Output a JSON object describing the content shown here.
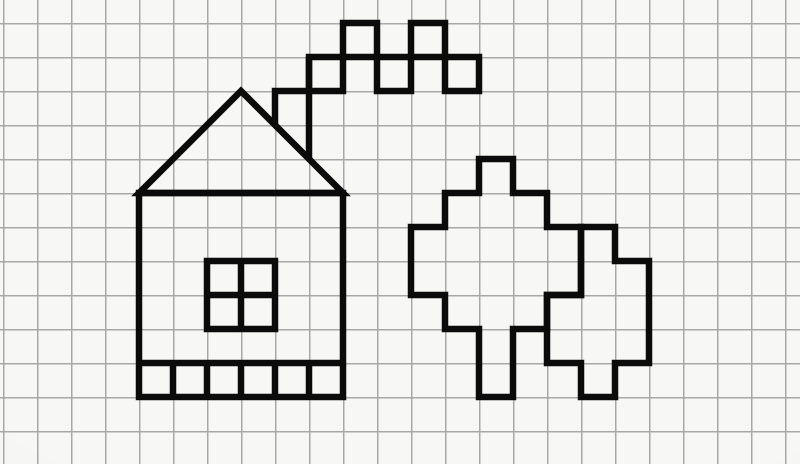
{
  "canvas": {
    "width": 800,
    "height": 464
  },
  "palette": {
    "ink": "#0b0b0b",
    "paper": "#f7f7f5",
    "grid_line": "#a8a8a8",
    "vignette": "rgba(95,95,90,0.13)"
  },
  "grid": {
    "cell": 34,
    "offset_x": 3,
    "offset_y": 23,
    "line_width": 1.3
  },
  "stroke_width": 6.5,
  "drawing": {
    "house": [
      {
        "name": "house-body",
        "type": "rect",
        "x": 139,
        "y": 193,
        "w": 204,
        "h": 204
      },
      {
        "name": "house-roof",
        "type": "polygon",
        "points": [
          [
            139,
            193
          ],
          [
            241,
            91
          ],
          [
            343,
            193
          ]
        ]
      },
      {
        "name": "window-frame",
        "type": "rect",
        "x": 207,
        "y": 261,
        "w": 68,
        "h": 68
      },
      {
        "name": "window-bar-vertical",
        "type": "line",
        "x1": 241,
        "y1": 261,
        "x2": 241,
        "y2": 329
      },
      {
        "name": "window-bar-horizontal",
        "type": "line",
        "x1": 207,
        "y1": 295,
        "x2": 275,
        "y2": 295
      },
      {
        "name": "foundation-top-line",
        "type": "line",
        "x1": 139,
        "y1": 363,
        "x2": 343,
        "y2": 363
      },
      {
        "name": "foundation-divider-1",
        "type": "line",
        "x1": 173,
        "y1": 363,
        "x2": 173,
        "y2": 397
      },
      {
        "name": "foundation-divider-2",
        "type": "line",
        "x1": 207,
        "y1": 363,
        "x2": 207,
        "y2": 397
      },
      {
        "name": "foundation-divider-3",
        "type": "line",
        "x1": 241,
        "y1": 363,
        "x2": 241,
        "y2": 397
      },
      {
        "name": "foundation-divider-4",
        "type": "line",
        "x1": 275,
        "y1": 363,
        "x2": 275,
        "y2": 397
      },
      {
        "name": "foundation-divider-5",
        "type": "line",
        "x1": 309,
        "y1": 363,
        "x2": 309,
        "y2": 397
      }
    ],
    "chimney_smoke": [
      {
        "name": "chimney-step",
        "type": "path",
        "d": "M 275 125 L 275 91 L 309 91"
      },
      {
        "name": "chimney-right-wall",
        "type": "line",
        "x1": 309,
        "y1": 57,
        "x2": 309,
        "y2": 159
      },
      {
        "name": "smoke-square-1",
        "type": "rect",
        "x": 309,
        "y": 57,
        "w": 34,
        "h": 34
      },
      {
        "name": "smoke-square-2",
        "type": "rect",
        "x": 343,
        "y": 23,
        "w": 34,
        "h": 34
      },
      {
        "name": "smoke-square-3",
        "type": "rect",
        "x": 377,
        "y": 57,
        "w": 34,
        "h": 34
      },
      {
        "name": "smoke-square-4",
        "type": "rect",
        "x": 411,
        "y": 23,
        "w": 34,
        "h": 34
      },
      {
        "name": "smoke-square-5",
        "type": "rect",
        "x": 445,
        "y": 57,
        "w": 34,
        "h": 34
      }
    ],
    "trees": [
      {
        "name": "left-tree-outline",
        "type": "polygon",
        "points": [
          [
            479,
            159
          ],
          [
            513,
            159
          ],
          [
            513,
            193
          ],
          [
            547,
            193
          ],
          [
            547,
            227
          ],
          [
            581,
            227
          ],
          [
            581,
            295
          ],
          [
            547,
            295
          ],
          [
            547,
            329
          ],
          [
            513,
            329
          ],
          [
            513,
            397
          ],
          [
            479,
            397
          ],
          [
            479,
            329
          ],
          [
            445,
            329
          ],
          [
            445,
            295
          ],
          [
            411,
            295
          ],
          [
            411,
            227
          ],
          [
            445,
            227
          ],
          [
            445,
            193
          ],
          [
            479,
            193
          ]
        ]
      },
      {
        "name": "right-tree-outline",
        "type": "polygon",
        "points": [
          [
            581,
            227
          ],
          [
            615,
            227
          ],
          [
            615,
            261
          ],
          [
            649,
            261
          ],
          [
            649,
            363
          ],
          [
            615,
            363
          ],
          [
            615,
            397
          ],
          [
            581,
            397
          ],
          [
            581,
            363
          ],
          [
            547,
            363
          ],
          [
            547,
            295
          ],
          [
            581,
            295
          ]
        ]
      }
    ]
  }
}
